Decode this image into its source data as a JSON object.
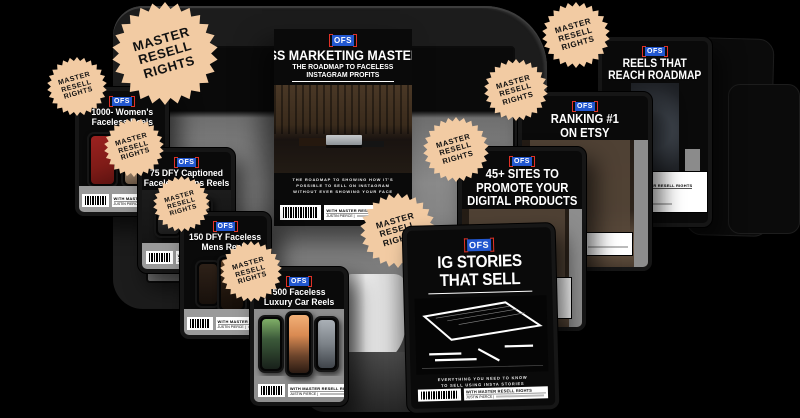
{
  "page": {
    "background": "#000000"
  },
  "brand": {
    "logo_text": "OFS",
    "logo_bg": "#2257cf",
    "logo_bracket": "#e23127"
  },
  "badge": {
    "line1": "MASTER",
    "line2": "RESELL",
    "line3": "RIGHTS",
    "fill": "#f2cba3"
  },
  "covers": {
    "masterclass": {
      "title1": "FACELESS MARKETING",
      "title2": "MASTERCLASS:",
      "subtitle1": "THE ROADMAP TO FACELESS",
      "subtitle2": "INSTAGRAM PROFITS",
      "caption1": "THE ROADMAP TO SHOWING HOW IT'S",
      "caption2": "POSSIBLE TO SELL ON INSTAGRAM",
      "caption3": "WITHOUT EVER SHOWING YOUR FACE",
      "footer_label": "WITH MASTER RESELL RIGHTS",
      "footer_sub": "JUSTIN PIERCE |"
    },
    "womens": {
      "title1": "1000- Women's",
      "title2": "Faceless Reels",
      "footer_label": "WITH MASTER RESELL RIGHTS",
      "footer_sub": "JUSTIN PIERCE |"
    },
    "mens75": {
      "title1": "75 DFY Captioned",
      "title2": "Faceless Mens Reels",
      "footer_label": "WITH MASTER RESELL RIGHTS",
      "footer_sub": "JUSTIN PIERCE |"
    },
    "mens150": {
      "title1": "150 DFY Faceless",
      "title2": "Mens Reels",
      "footer_label": "WITH MASTER RESELL RIGHTS",
      "footer_sub": "JUSTIN PIERCE |"
    },
    "cars500": {
      "title1": "500 Faceless",
      "title2": "Luxury Car Reels",
      "footer_label": "WITH MASTER RESELL RIGHTS",
      "footer_sub": "JUSTIN PIERCE |"
    },
    "igstories": {
      "title1": "IG STORIES",
      "title2": "THAT SELL",
      "caption1": "EVERYTHING YOU NEED TO KNOW",
      "caption2": "TO SELL USING INSTA STORIES",
      "footer_label": "WITH MASTER RESELL RIGHTS",
      "footer_sub": "JUSTIN PIERCE |"
    },
    "sites45": {
      "title1": "45+ SITES TO",
      "title2": "PROMOTE YOUR",
      "title3": "DIGITAL PRODUCTS",
      "caption1": "SITES TO PROMOTE",
      "caption2": "YOUR PRODUCTS",
      "footer_label": "WITH MASTER RESELL RIGHTS"
    },
    "ranking": {
      "title1": "RANKING #1",
      "title2": "ON ETSY",
      "caption1": "COURSE TO RANK",
      "caption2": "ON ETSY.",
      "footer_label": "MASTER RESELL RIGHTS"
    },
    "reelsreach": {
      "title1": "REELS THAT",
      "title2": "REACH ROADMAP",
      "caption1": "ELEVATE YOUR",
      "caption2": "NEXT LEVEL",
      "footer_label": "WITH MASTER RESELL RIGHTS"
    }
  }
}
